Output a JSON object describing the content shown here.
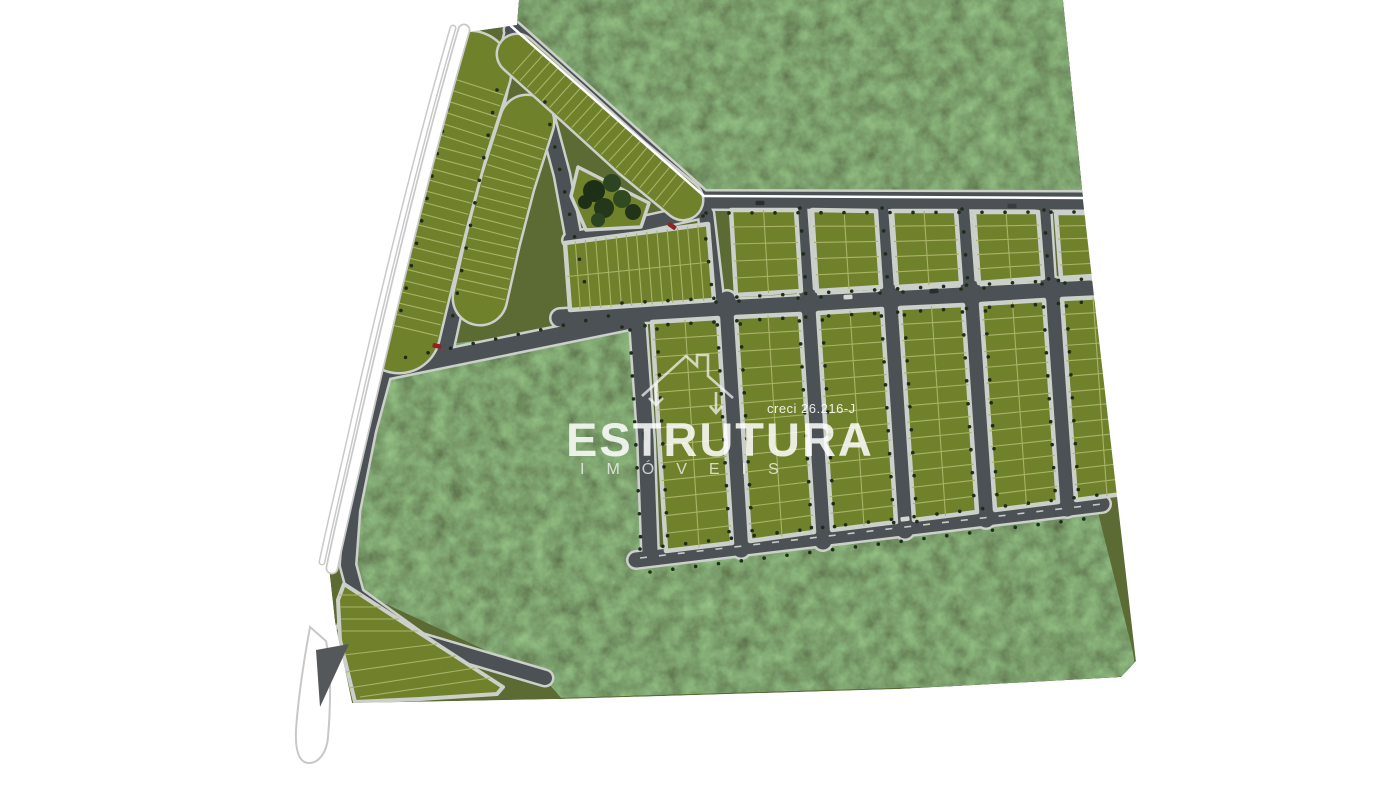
{
  "meta": {
    "description": "Aerial 3D masterplan render of a residential land-lot subdivision with roads, green lots, preserved woodland and a highway on the left",
    "canvas": {
      "w": 1400,
      "h": 787
    }
  },
  "watermark": {
    "brand": "ESTRUTURA",
    "subtitle": "IMÓVEIS",
    "license": "creci 26.216-J",
    "house_icon": "house-outline-with-down-arrows",
    "color": "#ffffff"
  },
  "palette": {
    "background": "#ffffff",
    "grass": "#5c6b33",
    "lot": "#70812c",
    "lot_line": "#a9b368",
    "sidewalk": "#cbd0ca",
    "road": "#4b5155",
    "forest": "#1f2f18",
    "highway": "#ffffff",
    "highway_casing": "#c9c9c9",
    "tree_dot": "#1d2d17",
    "dash_line": "#e8e8e6"
  },
  "site_plan": {
    "base": [
      [
        461,
        33
      ],
      [
        517,
        25
      ],
      [
        519,
        0
      ],
      [
        1063,
        0
      ],
      [
        1083,
        198
      ],
      [
        1137,
        660
      ],
      [
        1121,
        677
      ],
      [
        900,
        689
      ],
      [
        561,
        699
      ],
      [
        352,
        703
      ],
      [
        335,
        622
      ],
      [
        329,
        568
      ],
      [
        362,
        435
      ],
      [
        394,
        300
      ],
      [
        431,
        155
      ]
    ],
    "forests": [
      {
        "name": "north-forest",
        "pts": [
          [
            519,
            0
          ],
          [
            1063,
            0
          ],
          [
            1083,
            199
          ],
          [
            706,
            198
          ],
          [
            514,
            28
          ]
        ]
      },
      {
        "name": "central-and-south-forest",
        "pts": [
          [
            374,
            352
          ],
          [
            630,
            324
          ],
          [
            649,
            339
          ],
          [
            652,
            546
          ],
          [
            668,
            560
          ],
          [
            1097,
            508
          ],
          [
            1133,
            652
          ],
          [
            1136,
            672
          ],
          [
            1100,
            682
          ],
          [
            561,
            698
          ],
          [
            543,
            677
          ],
          [
            360,
            592
          ],
          [
            352,
            566
          ],
          [
            362,
            470
          ],
          [
            376,
            395
          ]
        ]
      }
    ],
    "roads": [
      {
        "pts": [
          [
            513,
            30
          ],
          [
            703,
            200
          ]
        ],
        "w": 16
      },
      {
        "pts": [
          [
            703,
            200
          ],
          [
            1083,
            201
          ]
        ],
        "w": 17
      },
      {
        "pts": [
          [
            560,
            318
          ],
          [
            1090,
            289
          ]
        ],
        "w": 17
      },
      {
        "pts": [
          [
            636,
            560
          ],
          [
            1102,
            504
          ]
        ],
        "w": 15
      },
      {
        "pts": [
          [
            501,
            80
          ],
          [
            478,
            185
          ],
          [
            460,
            280
          ],
          [
            443,
            358
          ]
        ],
        "w": 15
      },
      {
        "pts": [
          [
            378,
            372
          ],
          [
            633,
            320
          ]
        ],
        "w": 16
      },
      {
        "pts": [
          [
            395,
            330
          ],
          [
            368,
            430
          ],
          [
            352,
            510
          ],
          [
            348,
            565
          ],
          [
            356,
            595
          ]
        ],
        "w": 14
      },
      {
        "pts": [
          [
            356,
            595
          ],
          [
            420,
            641
          ],
          [
            545,
            678
          ]
        ],
        "w": 14
      },
      {
        "pts": [
          [
            638,
            326
          ],
          [
            646,
            440
          ],
          [
            650,
            552
          ]
        ],
        "w": 15
      },
      {
        "pts": [
          [
            542,
            100
          ],
          [
            562,
            175
          ],
          [
            574,
            240
          ],
          [
            585,
            300
          ],
          [
            612,
            315
          ]
        ],
        "w": 14
      },
      {
        "pts": [
          [
            570,
            240
          ],
          [
            705,
            210
          ]
        ],
        "w": 13
      },
      {
        "pts": [
          [
            706,
            214
          ],
          [
            716,
            300
          ]
        ],
        "w": 14
      },
      {
        "pts": [
          [
            800,
            206
          ],
          [
            806,
            292
          ]
        ],
        "w": 14
      },
      {
        "pts": [
          [
            881,
            207
          ],
          [
            887,
            290
          ]
        ],
        "w": 14
      },
      {
        "pts": [
          [
            962,
            208
          ],
          [
            968,
            288
          ]
        ],
        "w": 14
      },
      {
        "pts": [
          [
            1043,
            209
          ],
          [
            1048,
            286
          ]
        ],
        "w": 14
      },
      {
        "pts": [
          [
            727,
            300
          ],
          [
            741,
            549
          ]
        ],
        "w": 17
      },
      {
        "pts": [
          [
            809,
            297
          ],
          [
            823,
            541
          ]
        ],
        "w": 17
      },
      {
        "pts": [
          [
            891,
            293
          ],
          [
            905,
            530
          ]
        ],
        "w": 17
      },
      {
        "pts": [
          [
            972,
            289
          ],
          [
            986,
            519
          ]
        ],
        "w": 17
      },
      {
        "pts": [
          [
            1053,
            286
          ],
          [
            1067,
            508
          ]
        ],
        "w": 17
      },
      {
        "pts": [
          [
            338,
            648
          ],
          [
            358,
            600
          ]
        ],
        "w": 16
      },
      {
        "pts": [
          [
            513,
            32
          ],
          [
            501,
            78
          ]
        ],
        "w": 14
      }
    ],
    "bands": [
      {
        "name": "west-curved-block",
        "pts": [
          [
            470,
            72
          ],
          [
            448,
            140
          ],
          [
            427,
            218
          ],
          [
            410,
            286
          ],
          [
            399,
            332
          ]
        ],
        "hw": 40,
        "step": 11.5
      },
      {
        "name": "second-curved-block",
        "pts": [
          [
            527,
            122
          ],
          [
            508,
            182
          ],
          [
            493,
            240
          ],
          [
            480,
            298
          ]
        ],
        "hw": 26,
        "step": 10.5
      },
      {
        "name": "north-boundary-block",
        "pts": [
          [
            517,
            54
          ],
          [
            575,
            106
          ],
          [
            632,
            158
          ],
          [
            683,
            200
          ]
        ],
        "hw": 19,
        "step": 10
      }
    ],
    "blocks": [
      {
        "name": "tall-block-1",
        "p": [
          [
            652,
            322
          ],
          [
            718,
            318
          ],
          [
            732,
            543
          ],
          [
            666,
            551
          ]
        ],
        "h": 12,
        "v": 1
      },
      {
        "name": "tall-block-2",
        "p": [
          [
            736,
            317
          ],
          [
            800,
            314
          ],
          [
            814,
            532
          ],
          [
            750,
            541
          ]
        ],
        "h": 12,
        "v": 1
      },
      {
        "name": "tall-block-3",
        "p": [
          [
            818,
            313
          ],
          [
            882,
            309
          ],
          [
            896,
            522
          ],
          [
            832,
            530
          ]
        ],
        "h": 12,
        "v": 1
      },
      {
        "name": "tall-block-4",
        "p": [
          [
            900,
            308
          ],
          [
            963,
            305
          ],
          [
            977,
            512
          ],
          [
            914,
            520
          ]
        ],
        "h": 12,
        "v": 1
      },
      {
        "name": "tall-block-5",
        "p": [
          [
            981,
            304
          ],
          [
            1044,
            300
          ],
          [
            1058,
            502
          ],
          [
            995,
            510
          ]
        ],
        "h": 12,
        "v": 1
      },
      {
        "name": "tall-block-6",
        "p": [
          [
            1062,
            299
          ],
          [
            1124,
            296
          ],
          [
            1138,
            492
          ],
          [
            1076,
            500
          ]
        ],
        "h": 12,
        "v": 1
      },
      {
        "name": "top-row-block-1",
        "p": [
          [
            731,
            210
          ],
          [
            796,
            210
          ],
          [
            801,
            291
          ],
          [
            736,
            295
          ]
        ],
        "h": 4,
        "v": 1
      },
      {
        "name": "top-row-block-2",
        "p": [
          [
            812,
            210
          ],
          [
            876,
            211
          ],
          [
            881,
            287
          ],
          [
            817,
            291
          ]
        ],
        "h": 4,
        "v": 1
      },
      {
        "name": "top-row-block-3",
        "p": [
          [
            892,
            211
          ],
          [
            956,
            211
          ],
          [
            961,
            283
          ],
          [
            897,
            287
          ]
        ],
        "h": 4,
        "v": 1
      },
      {
        "name": "top-row-block-4",
        "p": [
          [
            974,
            212
          ],
          [
            1038,
            212
          ],
          [
            1043,
            278
          ],
          [
            979,
            283
          ]
        ],
        "h": 4,
        "v": 1
      },
      {
        "name": "top-row-block-5",
        "p": [
          [
            1056,
            213
          ],
          [
            1120,
            213
          ],
          [
            1125,
            274
          ],
          [
            1061,
            278
          ]
        ],
        "h": 4,
        "v": 1
      },
      {
        "name": "wide-block",
        "p": [
          [
            565,
            243
          ],
          [
            708,
            224
          ],
          [
            714,
            300
          ],
          [
            570,
            310
          ]
        ],
        "h": 1,
        "v": 13
      }
    ],
    "wedge": {
      "poly": [
        [
          344,
          584
        ],
        [
          503,
          687
        ],
        [
          497,
          694
        ],
        [
          420,
          699
        ],
        [
          355,
          702
        ],
        [
          340,
          640
        ],
        [
          338,
          600
        ]
      ],
      "lines": [
        [
          339,
          595,
          362,
          595
        ],
        [
          340,
          607,
          381,
          607
        ],
        [
          341,
          619,
          399,
          619
        ],
        [
          342,
          631,
          418,
          631
        ],
        [
          344,
          655,
          437,
          644
        ],
        [
          346,
          672,
          456,
          656
        ],
        [
          349,
          688,
          475,
          668
        ],
        [
          360,
          697,
          490,
          678
        ]
      ]
    },
    "park": {
      "poly": [
        [
          578,
          167
        ],
        [
          649,
          203
        ],
        [
          641,
          227
        ],
        [
          586,
          230
        ],
        [
          571,
          196
        ]
      ],
      "trees": [
        [
          594,
          191,
          11
        ],
        [
          612,
          183,
          9
        ],
        [
          604,
          208,
          10
        ],
        [
          622,
          199,
          9
        ],
        [
          633,
          212,
          8
        ],
        [
          598,
          220,
          7
        ],
        [
          585,
          202,
          7
        ]
      ],
      "tree_colors": [
        "#1e2f18",
        "#2c4422",
        "#24371b",
        "#31491f",
        "#22331a",
        "#2c4422",
        "#1e2f18"
      ]
    },
    "tree_dot_lines": [
      [
        706,
        213,
        1080,
        212
      ],
      [
        622,
        303,
        1086,
        279
      ],
      [
        622,
        327,
        1086,
        302
      ],
      [
        640,
        549,
        1098,
        495
      ],
      [
        650,
        572,
        1100,
        517
      ],
      [
        800,
        208,
        806,
        290
      ],
      [
        882,
        208,
        888,
        288
      ],
      [
        962,
        209,
        968,
        286
      ],
      [
        1044,
        210,
        1049,
        284
      ],
      [
        716,
        302,
        730,
        549
      ],
      [
        739,
        301,
        753,
        546
      ],
      [
        798,
        298,
        812,
        538
      ],
      [
        821,
        297,
        835,
        534
      ],
      [
        880,
        293,
        894,
        527
      ],
      [
        903,
        292,
        917,
        523
      ],
      [
        961,
        289,
        975,
        516
      ],
      [
        984,
        288,
        998,
        512
      ],
      [
        1042,
        284,
        1056,
        505
      ],
      [
        1065,
        283,
        1079,
        501
      ],
      [
        630,
        330,
        641,
        546
      ],
      [
        657,
        329,
        668,
        545
      ],
      [
        703,
        216,
        713,
        298
      ],
      [
        383,
        362,
        628,
        312
      ],
      [
        497,
        90,
        452,
        320
      ],
      [
        458,
        64,
        396,
        332
      ],
      [
        545,
        102,
        588,
        298
      ]
    ],
    "dashed_lines": [
      [
        640,
        558,
        1102,
        504
      ]
    ],
    "boundary_lines": [
      [
        511,
        26,
        704,
        196
      ],
      [
        704,
        196,
        1084,
        198
      ],
      [
        1084,
        198,
        1137,
        660
      ]
    ],
    "vehicles": [
      [
        760,
        203,
        0,
        "#2b2e30"
      ],
      [
        1012,
        206,
        0,
        "#3a3d3f"
      ],
      [
        848,
        297,
        -3,
        "#d8d8d3"
      ],
      [
        934,
        291,
        -3,
        "#2b2e30"
      ],
      [
        672,
        226,
        35,
        "#8f2424"
      ],
      [
        437,
        346,
        12,
        "#8f2424"
      ],
      [
        905,
        519,
        -7,
        "#d8d8d3"
      ],
      [
        645,
        436,
        85,
        "#2b2e30"
      ]
    ],
    "highway": {
      "inner": "M464,30 C432,140 398,278 366,418 C356,462 342,520 332,568",
      "outer": "M453,28 C421,138 387,276 355,416 C346,458 332,514 322,562"
    },
    "teardrop": {
      "path": "M310,627 C304,660 298,700 296,730 C295,753 300,763 309,763 C319,763 327,752 328,737 C331,703 331,666 326,641 Z",
      "pavement": [
        [
          316,
          650
        ],
        [
          349,
          644
        ],
        [
          320,
          707
        ]
      ]
    }
  }
}
